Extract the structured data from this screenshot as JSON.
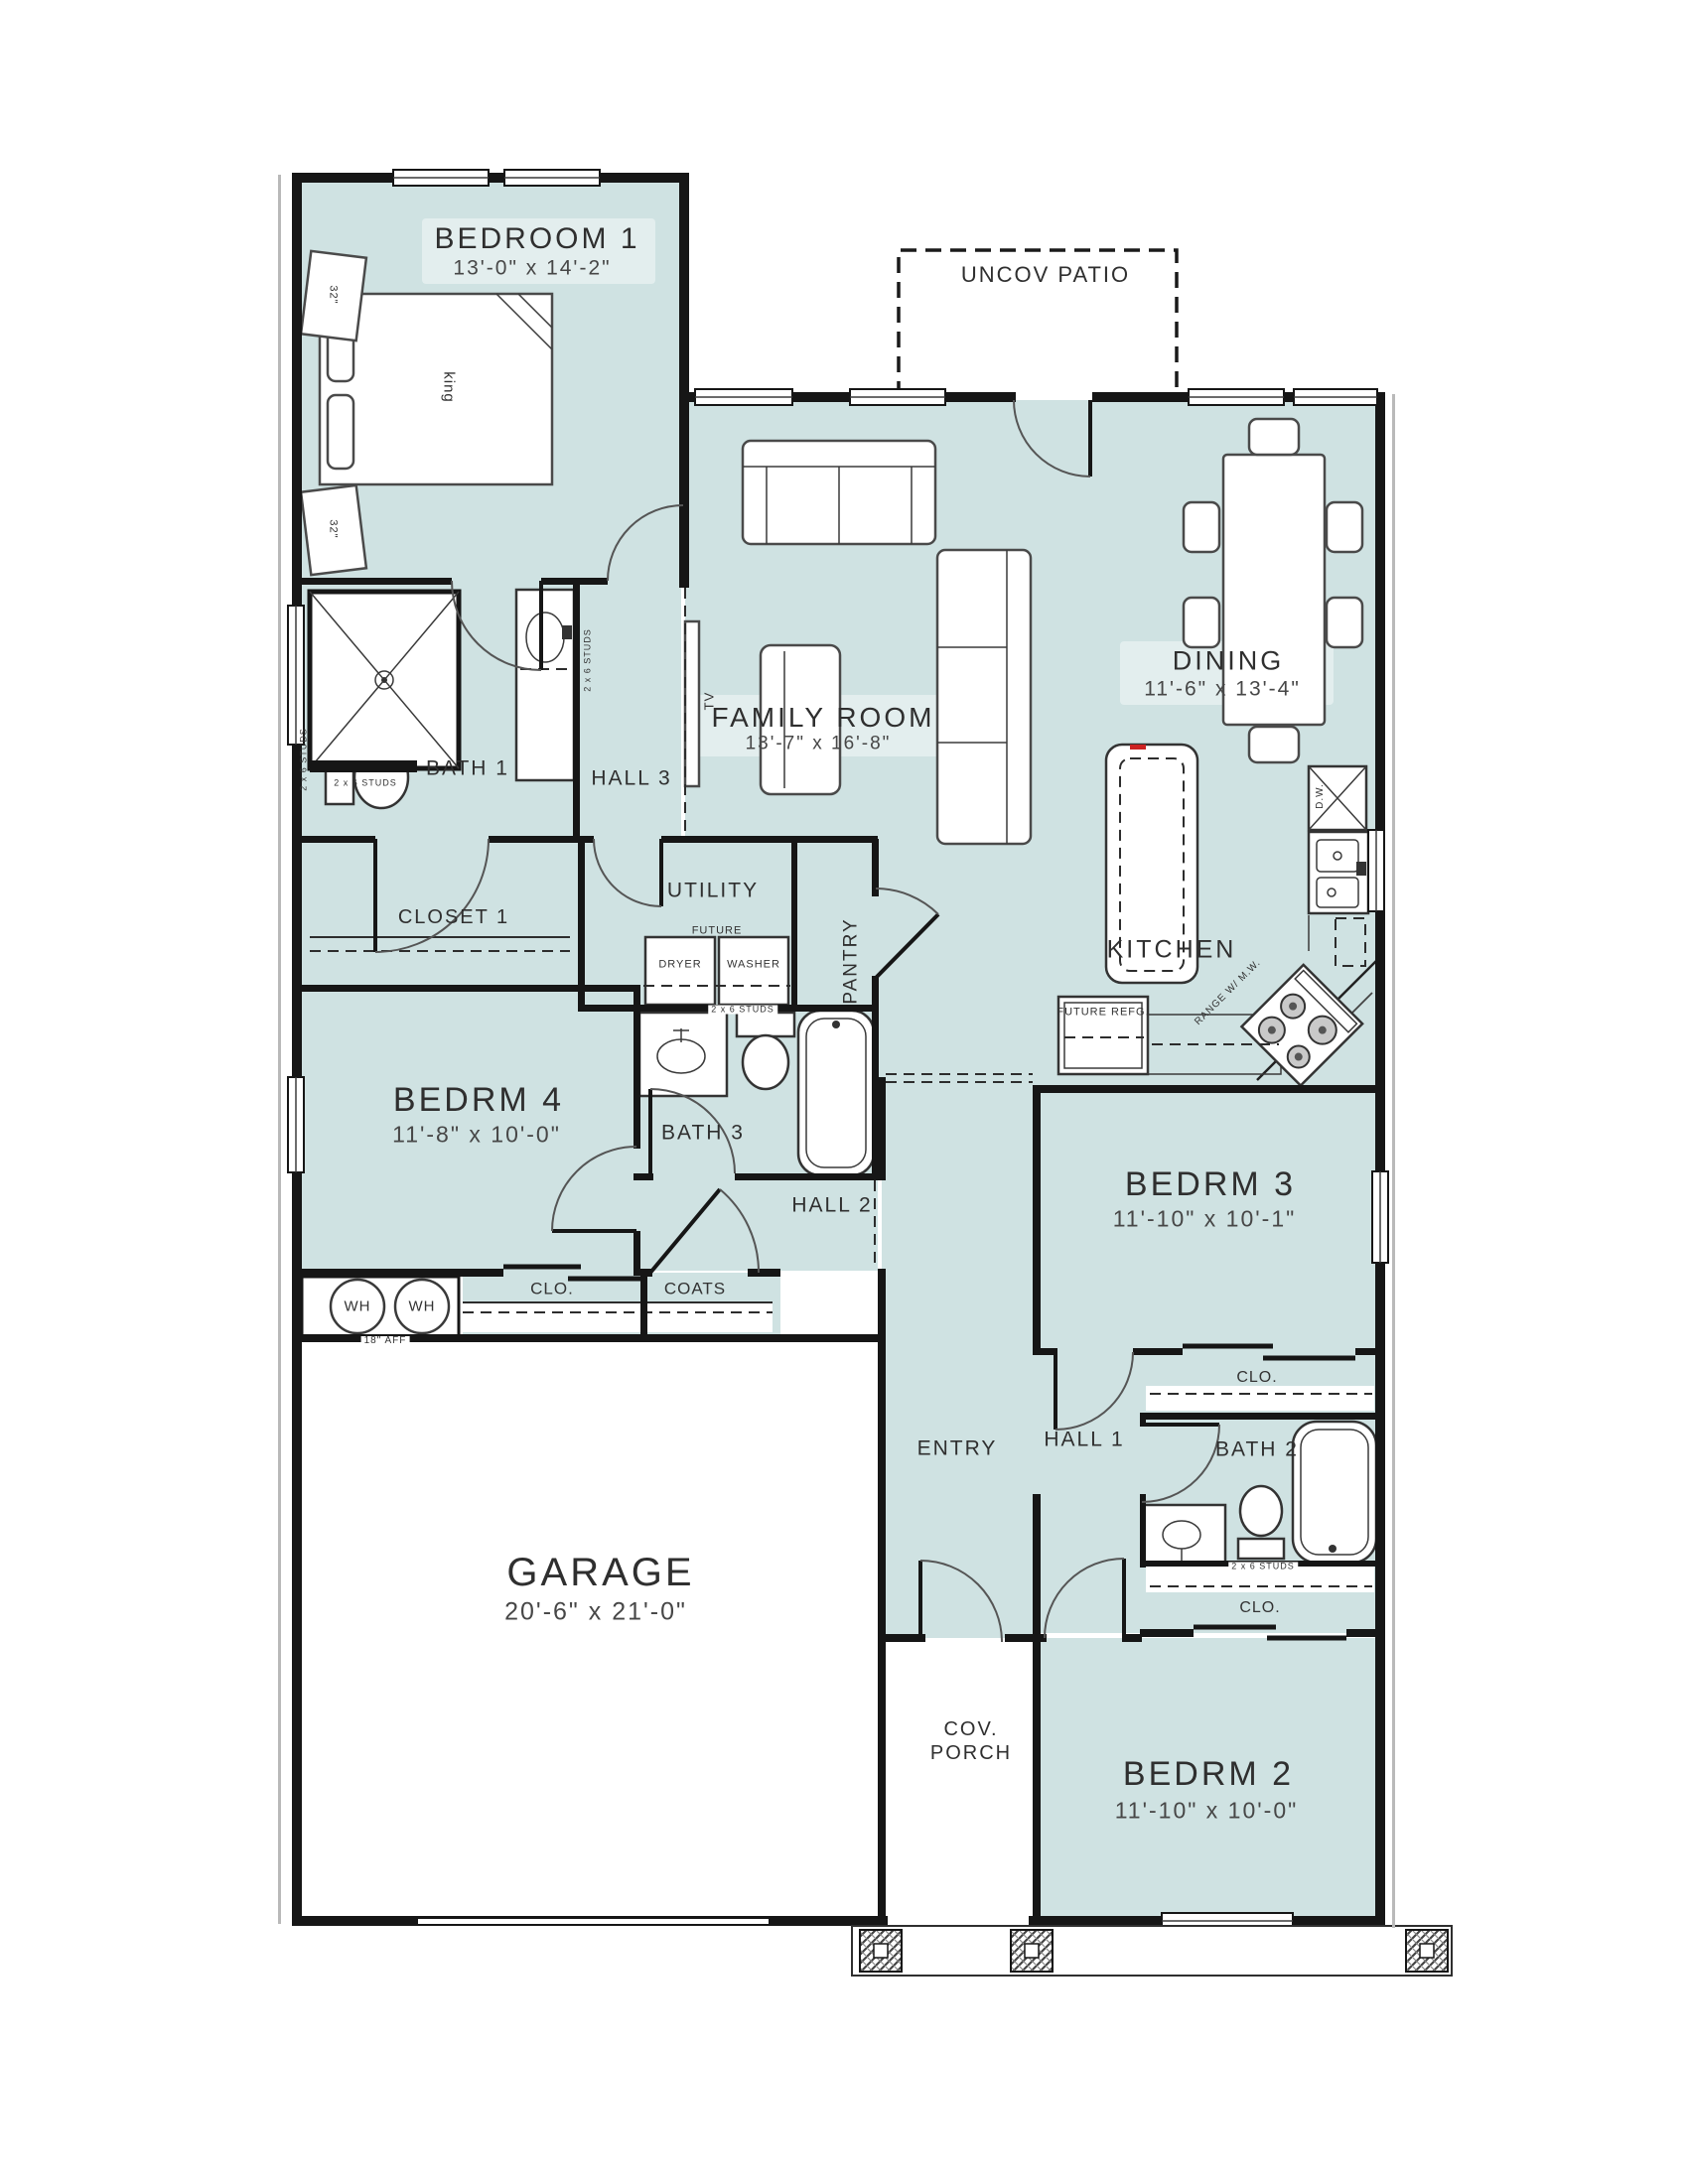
{
  "title": "Single-story house floor plan",
  "colors": {
    "room_fill": "#cfe2e2",
    "wall": "#161616",
    "text": "#2f2f2f",
    "accent_red": "#cc2222"
  },
  "rooms": {
    "bedroom1": {
      "name": "BEDROOM 1",
      "dims": "13'-0\" x 14'-2\""
    },
    "patio": {
      "name": "UNCOV PATIO"
    },
    "family_room": {
      "name": "FAMILY ROOM",
      "dims": "13'-7\" x 16'-8\""
    },
    "dining": {
      "name": "DINING",
      "dims": "11'-6\" x 13'-4\""
    },
    "kitchen": {
      "name": "KITCHEN"
    },
    "bath1": {
      "name": "BATH 1"
    },
    "hall3": {
      "name": "HALL 3"
    },
    "closet1": {
      "name": "CLOSET 1"
    },
    "utility": {
      "name": "UTILITY"
    },
    "pantry": {
      "name": "PANTRY"
    },
    "bedrm4": {
      "name": "BEDRM 4",
      "dims": "11'-8\" x 10'-0\""
    },
    "bath3": {
      "name": "BATH 3"
    },
    "hall2": {
      "name": "HALL 2"
    },
    "bedrm3": {
      "name": "BEDRM 3",
      "dims": "11'-10\" x 10'-1\""
    },
    "garage": {
      "name": "GARAGE",
      "dims": "20'-6\" x 21'-0\""
    },
    "entry": {
      "name": "ENTRY"
    },
    "hall1": {
      "name": "HALL 1"
    },
    "bath2": {
      "name": "BATH 2"
    },
    "bedrm2": {
      "name": "BEDRM 2",
      "dims": "11'-10\" x 10'-0\""
    },
    "cov_porch": {
      "line1": "COV.",
      "line2": "PORCH"
    },
    "closet_hall": {
      "name": "CLO."
    },
    "coats": {
      "name": "COATS"
    },
    "closet_bedrm3": {
      "name": "CLO."
    },
    "closet_bedrm2": {
      "name": "CLO."
    }
  },
  "fixtures": {
    "water_heater_1": "WH",
    "water_heater_2": "WH",
    "water_heater_note": "18\" AFF",
    "future": "FUTURE",
    "dryer": "DRYER",
    "washer": "WASHER",
    "future_refrigerator": "FUTURE REFG.",
    "dishwasher": "D.W.",
    "range": "RANGE W/ M.W.",
    "tv": "TV",
    "bed": "king",
    "nightstand_1": "32\"",
    "nightstand_2": "32\""
  },
  "annotations": {
    "studs": "2 x 6 STUDS"
  }
}
